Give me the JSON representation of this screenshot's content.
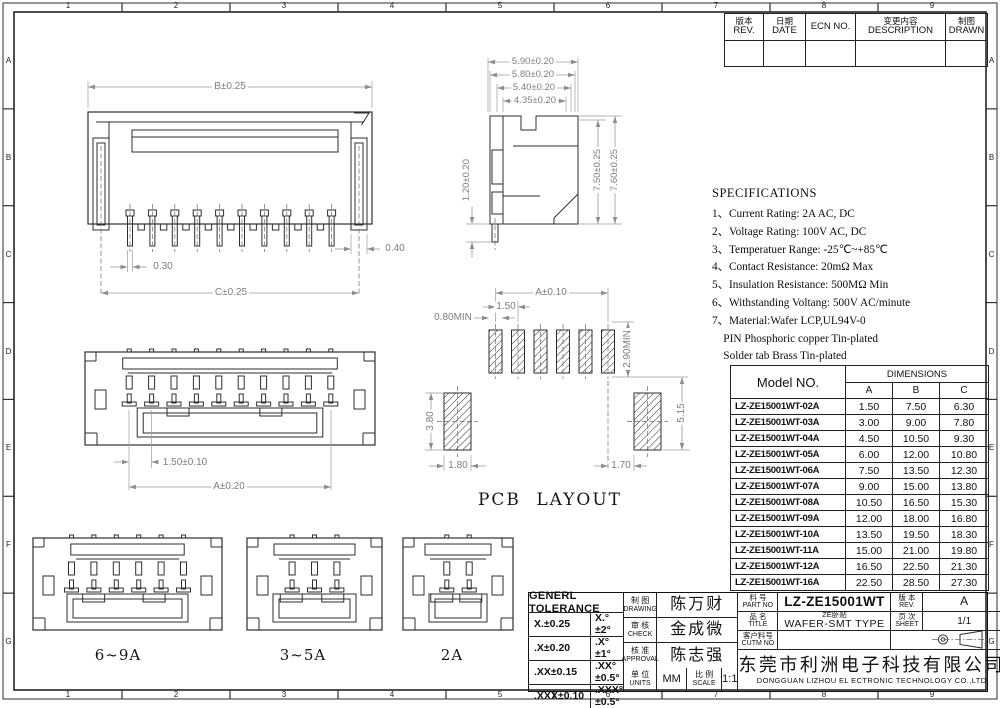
{
  "sheet": {
    "zones_h": [
      "1",
      "2",
      "3",
      "4",
      "5",
      "6",
      "7",
      "8",
      "9"
    ],
    "zones_v": [
      "A",
      "B",
      "C",
      "D",
      "E",
      "F",
      "G"
    ]
  },
  "revision_table": {
    "cols": [
      {
        "cn": "版本",
        "en": "REV."
      },
      {
        "cn": "日期",
        "en": "DATE"
      },
      {
        "cn": "",
        "en": "ECN NO."
      },
      {
        "cn": "变更内容",
        "en": "DESCRIPTION"
      },
      {
        "cn": "制图",
        "en": "DRAWN"
      }
    ]
  },
  "specs": {
    "title": "SPECIFICATIONS",
    "items": [
      "1、Current Rating: 2A AC, DC",
      "2、Voltage Rating: 100V AC, DC",
      "3、Temperatuer Range: -25℃~+85℃",
      "4、Contact Resistance: 20mΩ Max",
      "5、Insulation Resistance: 500MΩ Min",
      "6、Withstanding Voltang: 500V AC/minute",
      "7、Material:Wafer LCP,UL94V-0",
      "    PIN Phosphoric copper Tin-plated",
      "    Solder tab Brass Tin-plated"
    ]
  },
  "model_table": {
    "header_model": "Model NO.",
    "header_dimensions": "DIMENSIONS",
    "columns": [
      "A",
      "B",
      "C"
    ],
    "rows": [
      {
        "model": "LZ-ZE15001WT-02A",
        "a": "1.50",
        "b": "7.50",
        "c": "6.30"
      },
      {
        "model": "LZ-ZE15001WT-03A",
        "a": "3.00",
        "b": "9.00",
        "c": "7.80"
      },
      {
        "model": "LZ-ZE15001WT-04A",
        "a": "4.50",
        "b": "10.50",
        "c": "9.30"
      },
      {
        "model": "LZ-ZE15001WT-05A",
        "a": "6.00",
        "b": "12.00",
        "c": "10.80"
      },
      {
        "model": "LZ-ZE15001WT-06A",
        "a": "7.50",
        "b": "13.50",
        "c": "12.30"
      },
      {
        "model": "LZ-ZE15001WT-07A",
        "a": "9.00",
        "b": "15.00",
        "c": "13.80"
      },
      {
        "model": "LZ-ZE15001WT-08A",
        "a": "10.50",
        "b": "16.50",
        "c": "15.30"
      },
      {
        "model": "LZ-ZE15001WT-09A",
        "a": "12.00",
        "b": "18.00",
        "c": "16.80"
      },
      {
        "model": "LZ-ZE15001WT-10A",
        "a": "13.50",
        "b": "19.50",
        "c": "18.30"
      },
      {
        "model": "LZ-ZE15001WT-11A",
        "a": "15.00",
        "b": "21.00",
        "c": "19.80"
      },
      {
        "model": "LZ-ZE15001WT-12A",
        "a": "16.50",
        "b": "22.50",
        "c": "21.30"
      },
      {
        "model": "LZ-ZE15001WT-16A",
        "a": "22.50",
        "b": "28.50",
        "c": "27.30"
      }
    ]
  },
  "dims": {
    "front": {
      "top": "B±0.25",
      "bottom": "C±0.25",
      "pin": "0.30",
      "tab": "0.40"
    },
    "side": {
      "d1": "5.90±0.20",
      "d2": "5.80±0.20",
      "d3": "5.40±0.20",
      "d4": "4.35±0.20",
      "left": "1.20±0.20",
      "r1": "7.50±0.25",
      "r2": "7.60±0.25"
    },
    "mating": {
      "pitch": "1.50±0.10",
      "overall": "A±0.20"
    },
    "pcb": {
      "overall": "A±0.10",
      "pitch": "1.50",
      "pad": "0.80MIN",
      "gap": "2.90MIN",
      "right": "5.15",
      "left": "3.80",
      "bl": "1.80",
      "br": "1.70"
    }
  },
  "labels": {
    "pcb_layout": "PCB LAYOUT"
  },
  "variants": [
    "6~9A",
    "3~5A",
    "2A"
  ],
  "title_block": {
    "tolerance": {
      "title": "GENERL TOLERANCE",
      "rows": [
        [
          "X.±0.25",
          "X.°±2°"
        ],
        [
          ".X±0.20",
          ".X°±1°"
        ],
        [
          ".XX±0.15",
          ".XX°±0.5°"
        ],
        [
          ".XXX±0.10",
          ".XXX°±0.5°"
        ]
      ]
    },
    "roles": [
      {
        "cn": "制 图",
        "en": "DRAWING",
        "value": "陈万财"
      },
      {
        "cn": "审 核",
        "en": "CHECK",
        "value": "金成微"
      },
      {
        "cn": "核 准",
        "en": "APPROVAL",
        "value": "陈志强"
      }
    ],
    "units": {
      "cn": "单 位",
      "en": "UNITS",
      "value": "MM"
    },
    "scale": {
      "cn": "比 例",
      "en": "SCALE",
      "value": "1:1"
    },
    "part": {
      "cn": "料 号",
      "en": "PART NO",
      "value": "LZ-ZE15001WT"
    },
    "rev": {
      "cn": "版 本",
      "en": "REV.",
      "value": "A"
    },
    "title": {
      "cn": "品 名",
      "en": "TITLE",
      "sub": "ZE卧贴",
      "value": "WAFER-SMT TYPE"
    },
    "sheet": {
      "cn": "页 次",
      "en": "SHEET",
      "value": "1/1"
    },
    "cutm": {
      "cn": "客户料号",
      "en": "CUTM NO",
      "value": ""
    },
    "company_cn": "东莞市利洲电子科技有限公司",
    "company_en": "DONGGUAN LIZHOU EL ECTRONIC TECHNOLOGY CO.,LTD"
  }
}
